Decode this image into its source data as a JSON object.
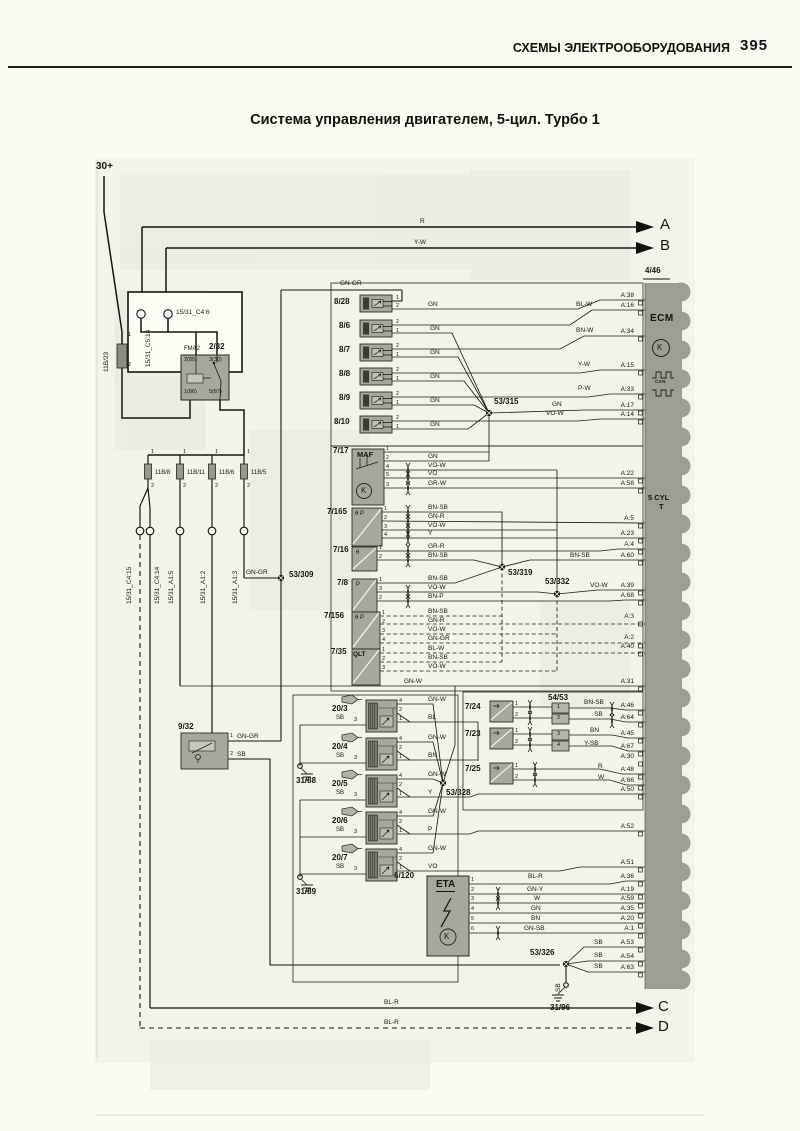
{
  "page": {
    "header": "СХЕМЫ ЭЛЕКТРООБОРУДОВАНИЯ",
    "page_number": "395",
    "title": "Система управления двигателем, 5-цил. Турбо 1"
  },
  "labels": [
    [
      "30+",
      96,
      162,
      "b11",
      "battery-30-label"
    ],
    [
      "15/31_C5:14",
      146,
      367,
      "w v",
      "connector-label"
    ],
    [
      "15/31_C4:6",
      176,
      310,
      "w",
      "connector-label"
    ],
    [
      "11B/23",
      104,
      372,
      "w v",
      "fuse-label"
    ],
    [
      "1",
      128,
      333,
      "t5"
    ],
    [
      "2",
      128,
      363,
      "t5"
    ],
    [
      "FMA2",
      184,
      346,
      "t6",
      "relay-name"
    ],
    [
      "2/32",
      209,
      343,
      "id",
      "relay-id"
    ],
    [
      "2(85)",
      184,
      358,
      "t5"
    ],
    [
      "3(30)",
      209,
      358,
      "t5"
    ],
    [
      "1(86)",
      184,
      390,
      "t5"
    ],
    [
      "5(87)",
      209,
      390,
      "t5"
    ],
    [
      "1",
      151,
      450,
      "t5"
    ],
    [
      "1",
      183,
      450,
      "t5"
    ],
    [
      "1",
      215,
      450,
      "t5"
    ],
    [
      "1",
      247,
      450,
      "t5"
    ],
    [
      "11B/8",
      155,
      470,
      "t6",
      "fuse-label"
    ],
    [
      "11B/11",
      187,
      470,
      "t6",
      "fuse-label"
    ],
    [
      "11B/6",
      219,
      470,
      "t6",
      "fuse-label"
    ],
    [
      "11B/5",
      251,
      470,
      "t6",
      "fuse-label"
    ],
    [
      "2",
      151,
      484,
      "t5"
    ],
    [
      "2",
      183,
      484,
      "t5"
    ],
    [
      "2",
      215,
      484,
      "t5"
    ],
    [
      "2",
      247,
      484,
      "t5"
    ],
    [
      "15/31_C4:15",
      127,
      604,
      "w v",
      "connector-label"
    ],
    [
      "15/31_C4:14",
      155,
      604,
      "w v",
      "connector-label"
    ],
    [
      "15/31_A1:5",
      169,
      604,
      "w v",
      "connector-label"
    ],
    [
      "15/31_A1:2",
      201,
      604,
      "w v",
      "connector-label"
    ],
    [
      "15/31_A1:3",
      233,
      604,
      "w v",
      "connector-label"
    ],
    [
      "GN-GR",
      246,
      570,
      "w"
    ],
    [
      "53/309",
      289,
      571,
      "id",
      "splice-id"
    ],
    [
      "R",
      420,
      219,
      "w"
    ],
    [
      "A",
      660,
      217,
      "big",
      "arrow-a"
    ],
    [
      "Y-W",
      414,
      240,
      "w"
    ],
    [
      "B",
      660,
      238,
      "big",
      "arrow-b"
    ],
    [
      "4/46",
      645,
      267,
      "id",
      "ecm-id"
    ],
    [
      "ECM",
      650,
      314,
      "ecmt",
      "ecm-label"
    ],
    [
      "K",
      657,
      344,
      "kk"
    ],
    [
      "CAN",
      655,
      380,
      "t45"
    ],
    [
      "5 CYL",
      648,
      494,
      "b8",
      "ecm-type"
    ],
    [
      "T",
      659,
      503,
      "b8",
      "ecm-type"
    ],
    [
      "8/28",
      334,
      298,
      "id",
      "component-id"
    ],
    [
      "8/6",
      339,
      322,
      "id",
      "component-id"
    ],
    [
      "8/7",
      339,
      346,
      "id",
      "component-id"
    ],
    [
      "8/8",
      339,
      370,
      "id",
      "component-id"
    ],
    [
      "8/9",
      339,
      394,
      "id",
      "component-id"
    ],
    [
      "8/10",
      334,
      418,
      "id",
      "component-id"
    ],
    [
      "1",
      396,
      296,
      "t5"
    ],
    [
      "2",
      396,
      304,
      "t5"
    ],
    [
      "2",
      396,
      320,
      "t5"
    ],
    [
      "1",
      396,
      329,
      "t5"
    ],
    [
      "2",
      396,
      344,
      "t5"
    ],
    [
      "1",
      396,
      353,
      "t5"
    ],
    [
      "2",
      396,
      368,
      "t5"
    ],
    [
      "1",
      396,
      377,
      "t5"
    ],
    [
      "2",
      396,
      392,
      "t5"
    ],
    [
      "1",
      396,
      401,
      "t5"
    ],
    [
      "2",
      396,
      416,
      "t5"
    ],
    [
      "1",
      396,
      425,
      "t5"
    ],
    [
      "GN-GR",
      340,
      281,
      "w"
    ],
    [
      "GN",
      428,
      302,
      "w"
    ],
    [
      "BL-W",
      576,
      302,
      "w"
    ],
    [
      "GN",
      430,
      326,
      "w"
    ],
    [
      "BN-W",
      576,
      328,
      "w"
    ],
    [
      "GN",
      430,
      350,
      "w"
    ],
    [
      "Y-W",
      578,
      362,
      "w"
    ],
    [
      "GN",
      430,
      374,
      "w"
    ],
    [
      "P-W",
      578,
      386,
      "w"
    ],
    [
      "GN",
      430,
      398,
      "w"
    ],
    [
      "53/315",
      494,
      398,
      "id",
      "splice-id"
    ],
    [
      "GN",
      552,
      402,
      "w"
    ],
    [
      "VO-W",
      546,
      411,
      "w"
    ],
    [
      "GN",
      430,
      422,
      "w"
    ],
    [
      "A:38",
      604,
      293,
      "p",
      "ecm-pin"
    ],
    [
      "A:16",
      604,
      303,
      "p",
      "ecm-pin"
    ],
    [
      "A:34",
      604,
      329,
      "p",
      "ecm-pin"
    ],
    [
      "A:15",
      604,
      363,
      "p",
      "ecm-pin"
    ],
    [
      "A:33",
      604,
      387,
      "p",
      "ecm-pin"
    ],
    [
      "A:17",
      604,
      403,
      "p",
      "ecm-pin"
    ],
    [
      "A:14",
      604,
      412,
      "p",
      "ecm-pin"
    ],
    [
      "A:22",
      604,
      471,
      "p",
      "ecm-pin"
    ],
    [
      "A:58",
      604,
      481,
      "p",
      "ecm-pin"
    ],
    [
      "A:5",
      604,
      516,
      "p",
      "ecm-pin"
    ],
    [
      "A:23",
      604,
      531,
      "p",
      "ecm-pin"
    ],
    [
      "A:4",
      604,
      542,
      "p",
      "ecm-pin"
    ],
    [
      "A:60",
      604,
      553,
      "p",
      "ecm-pin"
    ],
    [
      "A:39",
      604,
      583,
      "p",
      "ecm-pin"
    ],
    [
      "A:68",
      604,
      593,
      "p",
      "ecm-pin"
    ],
    [
      "A:3",
      604,
      614,
      "p",
      "ecm-pin"
    ],
    [
      "A:2",
      604,
      635,
      "p",
      "ecm-pin"
    ],
    [
      "A:40",
      604,
      644,
      "p",
      "ecm-pin"
    ],
    [
      "A:31",
      604,
      679,
      "p",
      "ecm-pin"
    ],
    [
      "A:46",
      604,
      703,
      "p",
      "ecm-pin"
    ],
    [
      "A:64",
      604,
      715,
      "p",
      "ecm-pin"
    ],
    [
      "A:45",
      604,
      731,
      "p",
      "ecm-pin"
    ],
    [
      "A:67",
      604,
      744,
      "p",
      "ecm-pin"
    ],
    [
      "A:30",
      604,
      754,
      "p",
      "ecm-pin"
    ],
    [
      "A:48",
      604,
      767,
      "p",
      "ecm-pin"
    ],
    [
      "A:66",
      604,
      778,
      "p",
      "ecm-pin"
    ],
    [
      "A:50",
      604,
      787,
      "p",
      "ecm-pin"
    ],
    [
      "A:52",
      604,
      824,
      "p",
      "ecm-pin"
    ],
    [
      "A:51",
      604,
      860,
      "p",
      "ecm-pin"
    ],
    [
      "A:36",
      604,
      874,
      "p",
      "ecm-pin"
    ],
    [
      "A:19",
      604,
      887,
      "p",
      "ecm-pin"
    ],
    [
      "A:59",
      604,
      896,
      "p",
      "ecm-pin"
    ],
    [
      "A:35",
      604,
      906,
      "p",
      "ecm-pin"
    ],
    [
      "A:20",
      604,
      916,
      "p",
      "ecm-pin"
    ],
    [
      "A:1",
      604,
      926,
      "p",
      "ecm-pin"
    ],
    [
      "A:53",
      604,
      940,
      "p",
      "ecm-pin"
    ],
    [
      "A:54",
      604,
      954,
      "p",
      "ecm-pin"
    ],
    [
      "A:63",
      604,
      965,
      "p",
      "ecm-pin"
    ],
    [
      "7/17",
      333,
      447,
      "id",
      "component-id"
    ],
    [
      "MAF",
      357,
      451,
      "b8",
      "component-label"
    ],
    [
      "1",
      386,
      447,
      "t5"
    ],
    [
      "2",
      386,
      456,
      "t5"
    ],
    [
      "4",
      386,
      465,
      "t5"
    ],
    [
      "5",
      386,
      473,
      "t5"
    ],
    [
      "3",
      386,
      483,
      "t5"
    ],
    [
      "K",
      361,
      487,
      "kk"
    ],
    [
      "GN",
      428,
      454,
      "w"
    ],
    [
      "VO-W",
      428,
      463,
      "w"
    ],
    [
      "VO",
      428,
      471,
      "w"
    ],
    [
      "GR-W",
      428,
      481,
      "w"
    ],
    [
      "7/165",
      327,
      508,
      "id",
      "component-id"
    ],
    [
      "θ P",
      355,
      511,
      "t6"
    ],
    [
      "1",
      384,
      507,
      "t5"
    ],
    [
      "2",
      384,
      516,
      "t5"
    ],
    [
      "3",
      384,
      525,
      "t5"
    ],
    [
      "4",
      384,
      533,
      "t5"
    ],
    [
      "BN-SB",
      428,
      505,
      "w"
    ],
    [
      "GN-R",
      428,
      514,
      "w"
    ],
    [
      "VO-W",
      428,
      523,
      "w"
    ],
    [
      "Y",
      428,
      531,
      "w"
    ],
    [
      "7/16",
      333,
      546,
      "id",
      "component-id"
    ],
    [
      "θ",
      356,
      550,
      "t6"
    ],
    [
      "1",
      379,
      546,
      "t5"
    ],
    [
      "2",
      379,
      555,
      "t5"
    ],
    [
      "GR-R",
      428,
      544,
      "w"
    ],
    [
      "BN-SB",
      428,
      553,
      "w"
    ],
    [
      "BN-SB",
      570,
      553,
      "w"
    ],
    [
      "7/8",
      337,
      579,
      "id",
      "component-id"
    ],
    [
      "P",
      356,
      582,
      "t6"
    ],
    [
      "1",
      379,
      578,
      "t5"
    ],
    [
      "3",
      379,
      587,
      "t5"
    ],
    [
      "2",
      379,
      596,
      "t5"
    ],
    [
      "BN-SB",
      428,
      576,
      "w"
    ],
    [
      "VO-W",
      428,
      585,
      "w"
    ],
    [
      "BN-P",
      428,
      594,
      "w"
    ],
    [
      "53/319",
      508,
      569,
      "id",
      "splice-id"
    ],
    [
      "53/332",
      545,
      578,
      "id",
      "splice-id"
    ],
    [
      "VO-W",
      590,
      583,
      "w"
    ],
    [
      "7/156",
      324,
      612,
      "id",
      "component-id"
    ],
    [
      "θ P",
      355,
      615,
      "t6"
    ],
    [
      "1",
      382,
      611,
      "t5"
    ],
    [
      "2",
      382,
      620,
      "t5"
    ],
    [
      "3",
      382,
      629,
      "t5"
    ],
    [
      "4",
      382,
      638,
      "t5"
    ],
    [
      "BN-SB",
      428,
      609,
      "w"
    ],
    [
      "GN-R",
      428,
      618,
      "w"
    ],
    [
      "VO-W",
      428,
      627,
      "w"
    ],
    [
      "GN-GR",
      428,
      636,
      "w"
    ],
    [
      "7/35",
      331,
      648,
      "id",
      "component-id"
    ],
    [
      "QLT",
      353,
      652,
      "t7b",
      "component-label"
    ],
    [
      "1",
      382,
      648,
      "t5"
    ],
    [
      "2",
      382,
      657,
      "t5"
    ],
    [
      "3",
      382,
      666,
      "t5"
    ],
    [
      "BL-W",
      428,
      646,
      "w"
    ],
    [
      "BN-SB",
      428,
      655,
      "w"
    ],
    [
      "VO-W",
      428,
      664,
      "w"
    ],
    [
      "GN-W",
      404,
      679,
      "w"
    ],
    [
      "20/3",
      332,
      705,
      "id",
      "component-id"
    ],
    [
      "SB",
      336,
      715,
      "t6"
    ],
    [
      "3",
      354,
      718,
      "t5"
    ],
    [
      "20/4",
      332,
      743,
      "id",
      "component-id"
    ],
    [
      "SB",
      336,
      753,
      "t6"
    ],
    [
      "3",
      354,
      756,
      "t5"
    ],
    [
      "20/5",
      332,
      780,
      "id",
      "component-id"
    ],
    [
      "SB",
      336,
      790,
      "t6"
    ],
    [
      "3",
      354,
      793,
      "t5"
    ],
    [
      "20/6",
      332,
      817,
      "id",
      "component-id"
    ],
    [
      "SB",
      336,
      827,
      "t6"
    ],
    [
      "3",
      354,
      830,
      "t5"
    ],
    [
      "20/7",
      332,
      854,
      "id",
      "component-id"
    ],
    [
      "SB",
      336,
      864,
      "t6"
    ],
    [
      "3",
      354,
      867,
      "t5"
    ],
    [
      "4",
      399,
      699,
      "t5"
    ],
    [
      "2",
      399,
      708,
      "t5"
    ],
    [
      "1",
      399,
      717,
      "t5"
    ],
    [
      "4",
      399,
      737,
      "t5"
    ],
    [
      "2",
      399,
      746,
      "t5"
    ],
    [
      "1",
      399,
      755,
      "t5"
    ],
    [
      "4",
      399,
      774,
      "t5"
    ],
    [
      "2",
      399,
      783,
      "t5"
    ],
    [
      "1",
      399,
      792,
      "t5"
    ],
    [
      "4",
      399,
      811,
      "t5"
    ],
    [
      "2",
      399,
      820,
      "t5"
    ],
    [
      "1",
      399,
      829,
      "t5"
    ],
    [
      "4",
      399,
      848,
      "t5"
    ],
    [
      "2",
      399,
      857,
      "t5"
    ],
    [
      "1",
      399,
      866,
      "t5"
    ],
    [
      "GN-W",
      428,
      697,
      "w"
    ],
    [
      "BL",
      428,
      715,
      "w"
    ],
    [
      "GN-W",
      428,
      735,
      "w"
    ],
    [
      "BN",
      428,
      753,
      "w"
    ],
    [
      "GN-W",
      428,
      772,
      "w"
    ],
    [
      "Y",
      428,
      790,
      "w"
    ],
    [
      "GN-W",
      428,
      809,
      "w"
    ],
    [
      "P",
      428,
      827,
      "w"
    ],
    [
      "GN-W",
      428,
      846,
      "w"
    ],
    [
      "VO",
      428,
      864,
      "w"
    ],
    [
      "31/88",
      296,
      777,
      "id",
      "ground-id"
    ],
    [
      "31/89",
      296,
      888,
      "id",
      "ground-id"
    ],
    [
      "53/328",
      446,
      789,
      "id",
      "splice-id"
    ],
    [
      "9/32",
      178,
      723,
      "id",
      "component-id"
    ],
    [
      "1",
      230,
      734,
      "t5"
    ],
    [
      "GN-GR",
      237,
      734,
      "w"
    ],
    [
      "2",
      230,
      752,
      "t5"
    ],
    [
      "SB",
      237,
      752,
      "w"
    ],
    [
      "7/24",
      465,
      703,
      "id",
      "component-id"
    ],
    [
      "1",
      515,
      702,
      "t5"
    ],
    [
      "2",
      515,
      713,
      "t5"
    ],
    [
      "7/23",
      465,
      730,
      "id",
      "component-id"
    ],
    [
      "1",
      515,
      729,
      "t5"
    ],
    [
      "2",
      515,
      740,
      "t5"
    ],
    [
      "7/25",
      465,
      765,
      "id",
      "component-id"
    ],
    [
      "1",
      515,
      764,
      "t5"
    ],
    [
      "2",
      515,
      775,
      "t5"
    ],
    [
      "54/53",
      548,
      694,
      "id",
      "connector-id"
    ],
    [
      "1",
      557,
      705,
      "t5"
    ],
    [
      "2",
      557,
      716,
      "t5"
    ],
    [
      "3",
      557,
      732,
      "t5"
    ],
    [
      "4",
      557,
      743,
      "t5"
    ],
    [
      "BN-SB",
      584,
      700,
      "w"
    ],
    [
      "SB",
      594,
      712,
      "w"
    ],
    [
      "BN",
      590,
      728,
      "w"
    ],
    [
      "Y-SB",
      584,
      741,
      "w"
    ],
    [
      "R",
      598,
      764,
      "w"
    ],
    [
      "W",
      598,
      775,
      "w"
    ],
    [
      "6/120",
      394,
      872,
      "id",
      "component-id"
    ],
    [
      "ETA",
      436,
      880,
      "eta",
      "component-label"
    ],
    [
      "K",
      444,
      933,
      "kk"
    ],
    [
      "1",
      471,
      878,
      "t5"
    ],
    [
      "2",
      471,
      888,
      "t5"
    ],
    [
      "3",
      471,
      897,
      "t5"
    ],
    [
      "4",
      471,
      907,
      "t5"
    ],
    [
      "5",
      471,
      917,
      "t5"
    ],
    [
      "6",
      471,
      927,
      "t5"
    ],
    [
      "BL-R",
      528,
      874,
      "w"
    ],
    [
      "GN-Y",
      527,
      887,
      "w"
    ],
    [
      "W",
      534,
      896,
      "w"
    ],
    [
      "GN",
      531,
      906,
      "w"
    ],
    [
      "BN",
      531,
      916,
      "w"
    ],
    [
      "GN-SB",
      524,
      926,
      "w"
    ],
    [
      "53/326",
      530,
      949,
      "id",
      "splice-id"
    ],
    [
      "SB",
      594,
      940,
      "w"
    ],
    [
      "SB",
      594,
      953,
      "w"
    ],
    [
      "SB",
      594,
      964,
      "w"
    ],
    [
      "SB",
      556,
      992,
      "w v"
    ],
    [
      "31/96",
      550,
      1004,
      "id",
      "ground-id"
    ],
    [
      "BL-R",
      384,
      1000,
      "w"
    ],
    [
      "C",
      658,
      999,
      "big",
      "arrow-c"
    ],
    [
      "BL-R",
      384,
      1020,
      "w"
    ],
    [
      "D",
      658,
      1019,
      "big",
      "arrow-d"
    ]
  ]
}
